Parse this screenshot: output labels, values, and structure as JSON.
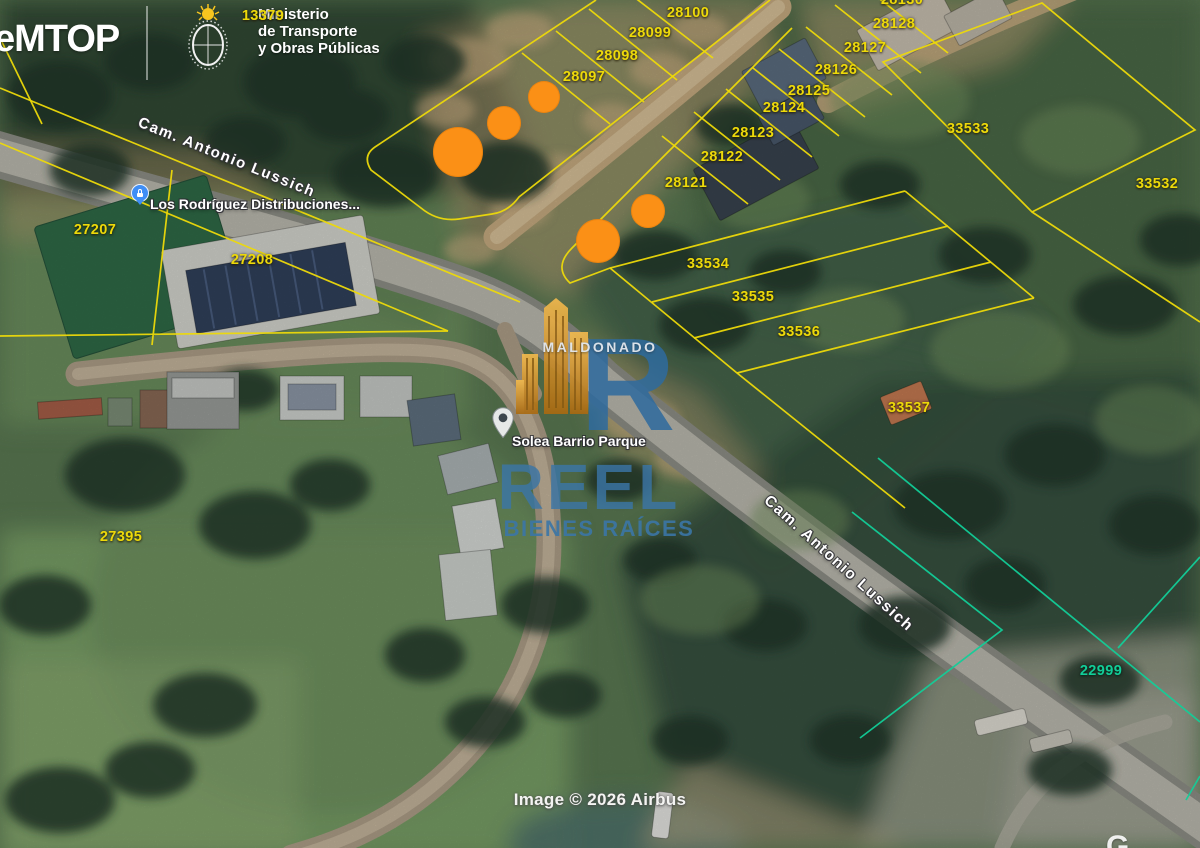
{
  "header": {
    "app_title": "eMTOP",
    "ministry_lines": [
      "Ministerio",
      "de Transporte",
      "y Obras Públicas"
    ]
  },
  "watermark": {
    "region": "MALDONADO",
    "brand": "REEL",
    "tagline": "BIENES RAÍCES",
    "logo_letter": "R"
  },
  "road_labels": [
    {
      "text": "Cam. Antonio Lussich"
    },
    {
      "text": "Cam. Antonio Lussich"
    }
  ],
  "poi": [
    {
      "label": "Los Rodríguez Distribuciones...",
      "icon": "blue-lock-marker"
    },
    {
      "label": "Solea Barrio Parque",
      "icon": "gray-pin"
    }
  ],
  "parcel_labels": {
    "yellow": [
      {
        "id": "13379",
        "x": 263,
        "y": 16
      },
      {
        "id": "28100",
        "x": 688,
        "y": 13
      },
      {
        "id": "28099",
        "x": 650,
        "y": 33
      },
      {
        "id": "28098",
        "x": 617,
        "y": 56
      },
      {
        "id": "28097",
        "x": 584,
        "y": 77
      },
      {
        "id": "28130",
        "x": 902,
        "y": 0
      },
      {
        "id": "28128",
        "x": 894,
        "y": 24
      },
      {
        "id": "28127",
        "x": 865,
        "y": 48
      },
      {
        "id": "28126",
        "x": 836,
        "y": 70
      },
      {
        "id": "28125",
        "x": 809,
        "y": 91
      },
      {
        "id": "28124",
        "x": 784,
        "y": 108
      },
      {
        "id": "28123",
        "x": 753,
        "y": 133
      },
      {
        "id": "28122",
        "x": 722,
        "y": 157
      },
      {
        "id": "28121",
        "x": 686,
        "y": 183
      },
      {
        "id": "33533",
        "x": 968,
        "y": 129
      },
      {
        "id": "33532",
        "x": 1157,
        "y": 184
      },
      {
        "id": "33534",
        "x": 708,
        "y": 264
      },
      {
        "id": "33535",
        "x": 753,
        "y": 297
      },
      {
        "id": "33536",
        "x": 799,
        "y": 332
      },
      {
        "id": "33537",
        "x": 909,
        "y": 408
      },
      {
        "id": "27207",
        "x": 95,
        "y": 230
      },
      {
        "id": "27208",
        "x": 252,
        "y": 260
      },
      {
        "id": "27395",
        "x": 121,
        "y": 537
      }
    ],
    "teal": [
      {
        "id": "22999",
        "x": 1101,
        "y": 671
      }
    ]
  },
  "listing_markers": [
    {
      "x": 458,
      "y": 152,
      "r": 25
    },
    {
      "x": 504,
      "y": 123,
      "r": 17
    },
    {
      "x": 544,
      "y": 97,
      "r": 16
    },
    {
      "x": 598,
      "y": 241,
      "r": 22
    },
    {
      "x": 648,
      "y": 211,
      "r": 17
    }
  ],
  "attribution": {
    "imagery": "Image © 2026 Airbus",
    "partial_logo": "G"
  },
  "colors": {
    "parcel_yellow": "#EDD90A",
    "parcel_teal": "#12CD98",
    "marker_orange": "#FB9016",
    "watermark_blue": "#3B75A6",
    "logo_gold": "#E8A43C",
    "poi_blue": "#3F8EF5"
  }
}
